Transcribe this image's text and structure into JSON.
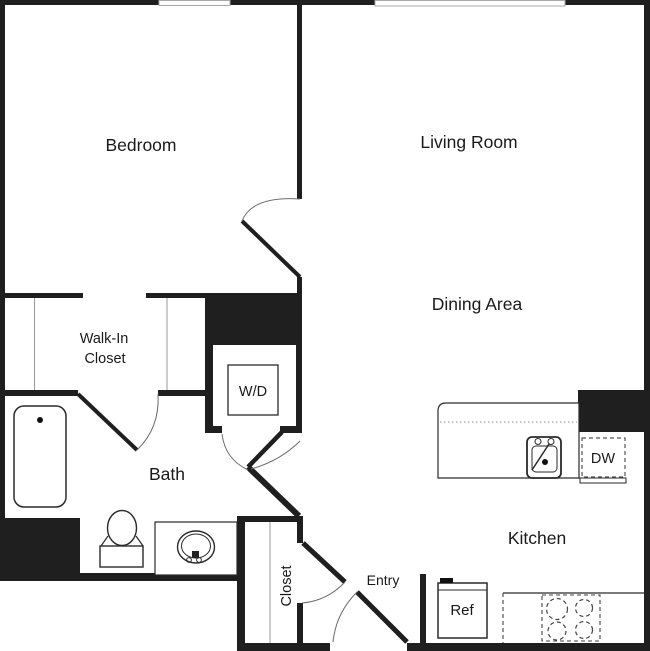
{
  "page": {
    "title": "One Bedroom Apartment Floor Plan",
    "background": "#ffffff"
  },
  "colors": {
    "wall": "#1f1f1f",
    "door_arc": "#6b6b6b",
    "fixture_outline": "#2a2a2a",
    "closet_rod_line": "#9a9a9a",
    "window_outline": "#a8a8a8",
    "text": "#1a1a1a"
  },
  "rooms": {
    "bedroom": {
      "label": "Bedroom"
    },
    "living_room": {
      "label": "Living Room"
    },
    "dining_area": {
      "label": "Dining Area"
    },
    "walk_in_closet": {
      "label_line1": "Walk-In",
      "label_line2": "Closet"
    },
    "bath": {
      "label": "Bath"
    },
    "closet": {
      "label": "Closet"
    },
    "entry": {
      "label": "Entry"
    },
    "kitchen": {
      "label": "Kitchen"
    }
  },
  "fixtures": {
    "washer_dryer": {
      "label": "W/D"
    },
    "refrigerator": {
      "label": "Ref"
    },
    "dishwasher": {
      "label": "DW"
    }
  }
}
